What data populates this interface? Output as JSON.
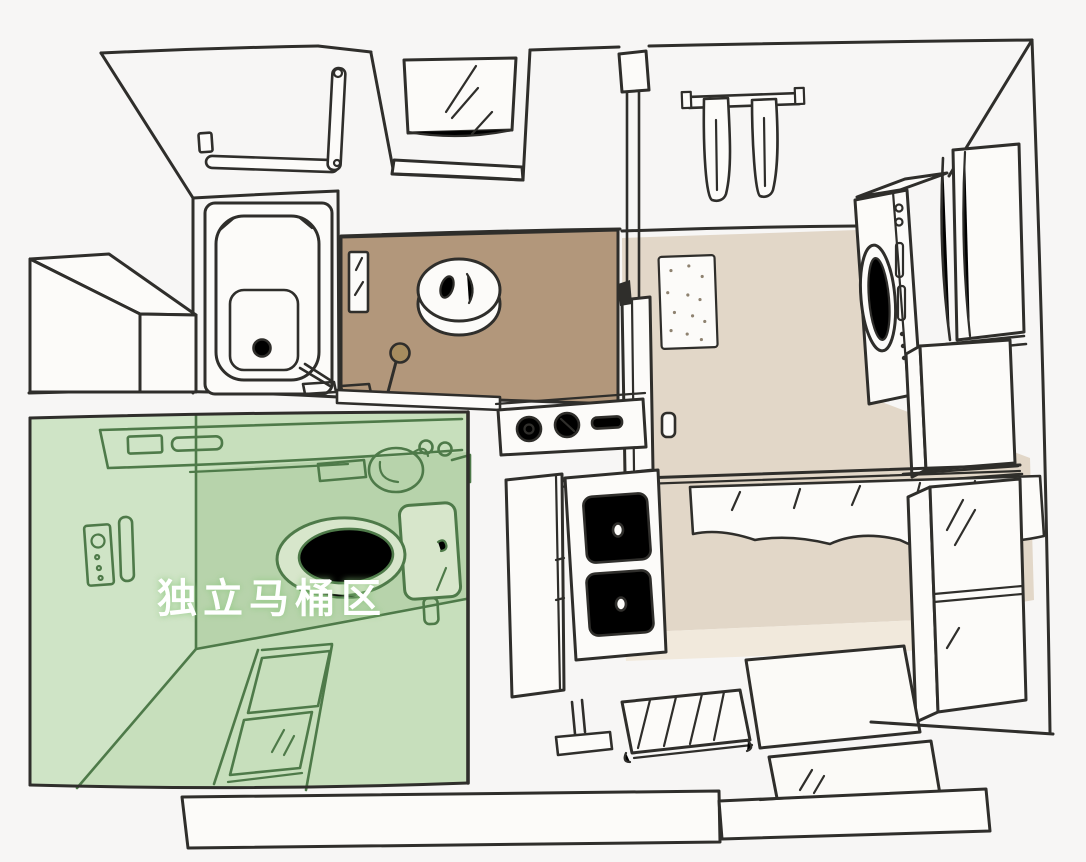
{
  "annotation": {
    "label": "独立马桶区"
  },
  "colors": {
    "background": "#f7f6f5",
    "ink": "#2f2e2b",
    "paper": "#fcfbf9",
    "wet_floor": "#b2977b",
    "dressing_floor": "#e2d7c8",
    "threshold_strip": "#f1e9dc",
    "highlight": "#c7dfbc",
    "highlight_wall": "#cfe4c6",
    "highlight_shade": "#b7d3ab",
    "highlight_ink": "#4e7a49",
    "toilet_fill": "#d7e6cb",
    "label_text": "#ffffff",
    "label_glow": "#8cc77e"
  },
  "depicted_objects": [
    "bathtub",
    "bath-grab-bar",
    "soap-dish",
    "window",
    "wash-area-brown-floor",
    "bath-stool",
    "hand-ladle",
    "wall-mirror-panel",
    "glass-partition-post",
    "towel-rail",
    "hanging-towels",
    "dotted-bath-mat",
    "washing-machine",
    "tall-cabinet",
    "storage-cabinet",
    "display-cabinet",
    "curtain-valance",
    "vanity-side-panel",
    "vanity-drawers",
    "water-heater-control-panel",
    "toilet",
    "toilet-remote-panel",
    "support-handle",
    "door-handle",
    "tile-step",
    "floor-mats",
    "drying-rack",
    "step-stand",
    "threshold-steps",
    "toilet-zone-highlight"
  ]
}
